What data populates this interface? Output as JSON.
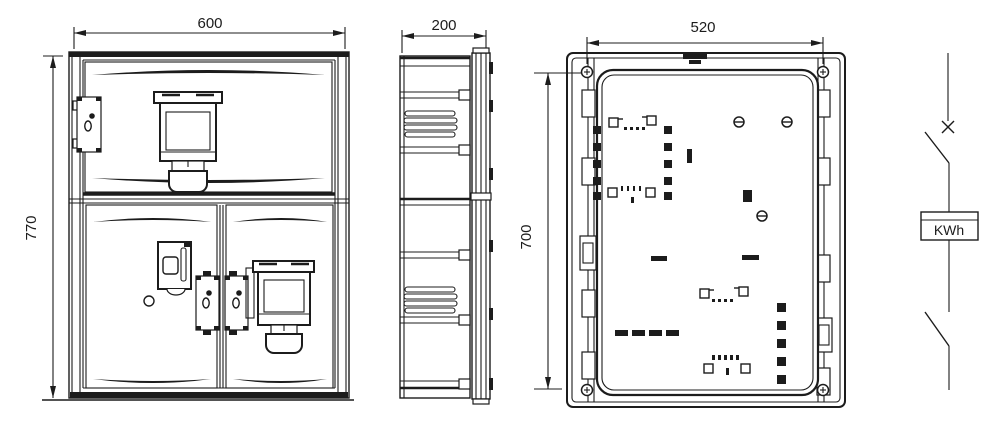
{
  "colors": {
    "line": "#1c1c1c",
    "background": "#ffffff"
  },
  "dimensions": {
    "front_width": "600",
    "front_height": "770",
    "side_depth": "200",
    "back_width": "520",
    "back_height": "700"
  },
  "schematic": {
    "meter_label": "KWh"
  }
}
